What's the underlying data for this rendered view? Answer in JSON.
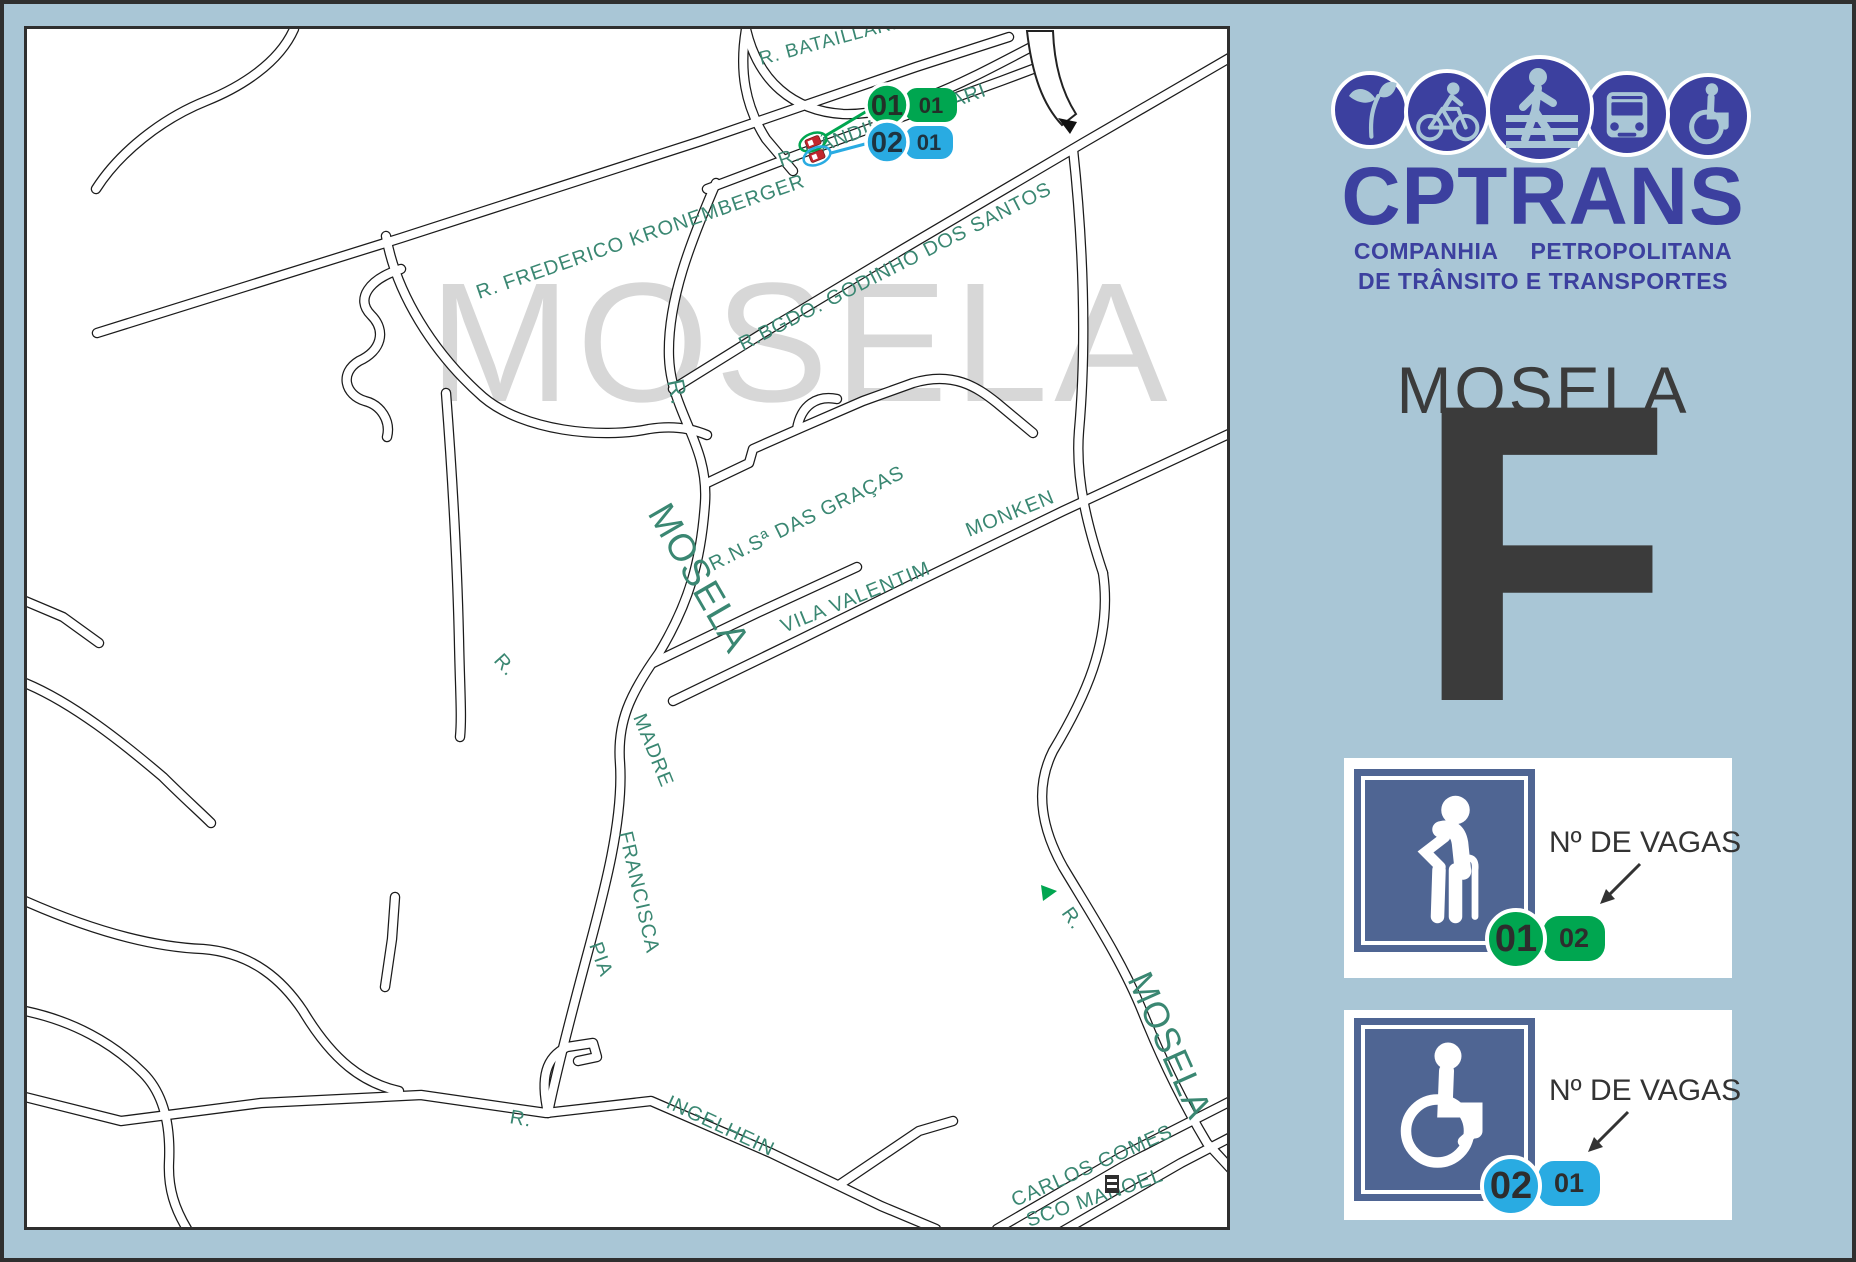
{
  "colors": {
    "panel_blue": "#a9c6d6",
    "brand_indigo": "#3c409f",
    "map_label_green": "#3a8772",
    "watermark_gray": "#d7d7d7",
    "badge_green": "#00a650",
    "badge_cyan": "#29abe2",
    "legend_icon_blue": "#4f6593",
    "marker_red": "#c1272d",
    "dark_text": "#333333"
  },
  "brand": {
    "name": "CPTRANS",
    "subtitle1": "COMPANHIA PETROPOLITANA",
    "subtitle2": "DE TRÂNSITO E TRANSPORTES",
    "icons": [
      "plant-icon",
      "cyclist-icon",
      "pedestrian-icon",
      "bus-icon",
      "wheelchair-icon"
    ]
  },
  "area_title": "MOSELA",
  "zone_letter": "F",
  "legend": [
    {
      "icon": "elderly",
      "label": "Nº DE VAGAS",
      "circle_value": "01",
      "pill_value": "02",
      "color": "#00a650"
    },
    {
      "icon": "wheelchair",
      "label": "Nº DE VAGAS",
      "circle_value": "02",
      "pill_value": "01",
      "color": "#29abe2"
    }
  ],
  "map": {
    "watermark": {
      "text": "MOSELA",
      "x": 428,
      "y": 400,
      "size": 170,
      "letter_spacing": 6
    },
    "markers": {
      "green": {
        "circle": "01",
        "pill": "01"
      },
      "cyan": {
        "circle": "02",
        "pill": "01"
      }
    },
    "streets": [
      "M 293 28 C 278 62 240 86 205 100 C 160 118 118 152 95 188",
      "M 96 332 L 400 237 L 700 140 L 915 66 L 1008 36",
      "M 745 28 C 738 70 744 105 765 138 L 792 170",
      "M 745 28 C 757 80 792 110 842 113 C 905 115 972 76 1038 42",
      "M 706 188 L 812 148 L 1000 80 L 1048 62",
      "M 715 182 C 690 240 666 300 668 356 C 670 412 708 442 704 502 C 700 560 688 602 658 652 C 628 694 616 722 619 762 C 623 822 600 902 584 962 C 568 1022 553 1082 547 1112",
      "M 385 235 C 395 292 432 352 482 396 C 522 430 600 438 648 428 C 672 424 692 428 706 434",
      "M 400 268 C 368 278 354 298 370 314 C 386 330 380 350 358 360 C 338 372 344 394 364 400 C 380 404 390 420 386 436",
      "M 445 392 C 451 470 456 552 458 640 C 459 690 461 716 459 736",
      "M 706 482 L 748 462 L 752 448 L 802 426 L 862 400 L 912 382 C 952 370 976 386 996 402 L 1032 432",
      "M 796 428 C 800 404 816 394 836 398",
      "M 672 700 L 800 638 L 922 578 L 1062 510 L 1230 432",
      "M 652 662 L 756 612 L 856 566",
      "M 672 388 L 762 332 L 902 248 L 1082 142 L 1230 56",
      "M 1072 148 C 1082 240 1086 340 1078 430 C 1074 480 1088 530 1102 572",
      "M 1102 572 C 1112 640 1082 700 1052 750 C 1032 790 1042 830 1062 866 C 1092 916 1122 962 1142 1012 C 1162 1062 1182 1102 1206 1142 L 1230 1168",
      "M 996 1228 L 1120 1156 L 1230 1100",
      "M 1062 1230 L 1180 1162 L 1230 1136",
      "M 24 1096 L 120 1120 L 260 1102 L 420 1094 L 545 1112 L 650 1100 L 770 1152 L 880 1205 L 935 1228",
      "M 838 1184 L 918 1130 L 952 1120",
      "M 547 1112 C 539 1076 545 1056 566 1046 L 592 1042 L 596 1056 L 577 1060",
      "M 24 900 C 92 930 152 946 202 948 C 252 952 282 980 302 1010 C 332 1060 362 1082 398 1090",
      "M 384 986 L 391 938 L 394 896",
      "M 24 682 C 72 702 122 742 162 776 C 182 796 200 812 210 822",
      "M 24 1010 C 72 1020 112 1042 142 1072 C 162 1092 170 1122 168 1162 C 167 1188 174 1208 186 1228",
      "M 24 600 L 62 616 L 98 642"
    ],
    "labels": [
      {
        "text": "R.  BATAILLARD",
        "x": 760,
        "y": 64,
        "rot": -15,
        "size": 19
      },
      {
        "text": "R.   FREDERICO  KRONEMBERGER",
        "x": 478,
        "y": 298,
        "rot": -19,
        "size": 20
      },
      {
        "text": "R. CÂNDIDO",
        "x": 780,
        "y": 166,
        "rot": -20,
        "size": 20
      },
      {
        "text": "NARI",
        "x": 938,
        "y": 112,
        "rot": -20,
        "size": 20
      },
      {
        "text": "R.BGDO.  GODINHO  DOS  SANTOS",
        "x": 742,
        "y": 350,
        "rot": -27,
        "size": 20
      },
      {
        "text": "R.",
        "x": 666,
        "y": 380,
        "rot": 78,
        "size": 24
      },
      {
        "text": "MOSELA",
        "x": 646,
        "y": 512,
        "rot": 60,
        "size": 38
      },
      {
        "text": "R.N.Sª  DAS  GRAÇAS",
        "x": 712,
        "y": 570,
        "rot": -26,
        "size": 20
      },
      {
        "text": "VILA  VALENTIM",
        "x": 783,
        "y": 632,
        "rot": -22,
        "size": 20
      },
      {
        "text": "MONKEN",
        "x": 968,
        "y": 536,
        "rot": -22,
        "size": 20
      },
      {
        "text": "R.",
        "x": 492,
        "y": 660,
        "rot": 48,
        "size": 20
      },
      {
        "text": "MADRE",
        "x": 632,
        "y": 716,
        "rot": 68,
        "size": 20
      },
      {
        "text": "FRANCISCA",
        "x": 618,
        "y": 832,
        "rot": 77,
        "size": 20
      },
      {
        "text": "PIA",
        "x": 588,
        "y": 944,
        "rot": 70,
        "size": 20
      },
      {
        "text": "R.",
        "x": 508,
        "y": 1122,
        "rot": 10,
        "size": 20
      },
      {
        "text": "INGELHEIN",
        "x": 664,
        "y": 1106,
        "rot": 25,
        "size": 20
      },
      {
        "text": "R.",
        "x": 1060,
        "y": 912,
        "rot": 55,
        "size": 20
      },
      {
        "text": "MOSELA",
        "x": 1126,
        "y": 978,
        "rot": 66,
        "size": 36
      },
      {
        "text": "CARLOS   GOMES",
        "x": 1014,
        "y": 1206,
        "rot": -24,
        "size": 20
      },
      {
        "text": "SCO   MANOEL",
        "x": 1028,
        "y": 1226,
        "rot": -19,
        "size": 20
      }
    ]
  }
}
